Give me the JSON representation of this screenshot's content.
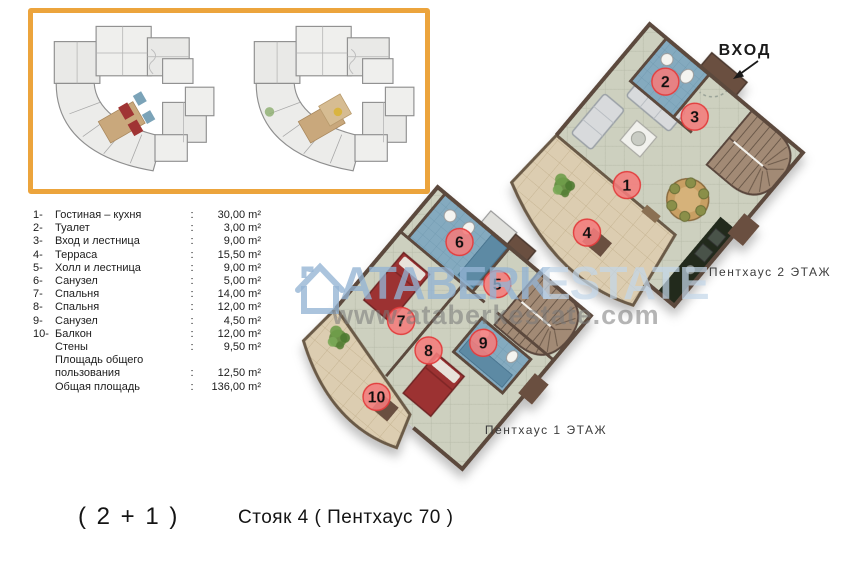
{
  "page": {
    "background": "#ffffff"
  },
  "colors": {
    "accent_border": "#ECA43C",
    "marker_fill": "#F47C7C",
    "marker_ring": "#E23D3D",
    "floor_tile": "#CDD0BF",
    "terrace_tile": "#DCCDB1",
    "bathroom_blue": "#84AABF",
    "bed_red": "#9C3030",
    "wall_brown": "#5C4A3E",
    "stair_brown": "#A28A75",
    "watermark_blue": "#94B4D4",
    "watermark_gray": "#787878"
  },
  "legend": {
    "items": [
      {
        "num": "1-",
        "name": "Гостиная – кухня",
        "sep": ":",
        "value": "30,00 m²"
      },
      {
        "num": "2-",
        "name": "Туалет",
        "sep": ":",
        "value": "3,00 m²"
      },
      {
        "num": "3-",
        "name": "Вход и лестница",
        "sep": ":",
        "value": "9,00 m²"
      },
      {
        "num": "4-",
        "name": "Терраса",
        "sep": ":",
        "value": "15,50 m²"
      },
      {
        "num": "5-",
        "name": "Холл и лестница",
        "sep": ":",
        "value": "9,00 m²"
      },
      {
        "num": "6-",
        "name": "Санузел",
        "sep": ":",
        "value": "5,00 m²"
      },
      {
        "num": "7-",
        "name": "Спальня",
        "sep": ":",
        "value": "14,00 m²"
      },
      {
        "num": "8-",
        "name": "Спальня",
        "sep": ":",
        "value": "12,00 m²"
      },
      {
        "num": "9-",
        "name": "Санузел",
        "sep": ":",
        "value": "4,50 m²"
      },
      {
        "num": "10-",
        "name": "Балкон",
        "sep": ":",
        "value": "12,00 m²"
      },
      {
        "num": "",
        "name": "Стены",
        "sep": ":",
        "value": "9,50 m²"
      },
      {
        "num": "",
        "name": "Площадь общего",
        "sep": "",
        "value": ""
      },
      {
        "num": "",
        "name": "пользования",
        "sep": ":",
        "value": "12,50 m²"
      },
      {
        "num": "",
        "name": "Общая площадь",
        "sep": ":",
        "value": "136,00 m²"
      }
    ]
  },
  "plans": {
    "floor2": {
      "label": "Пентхаус 2 ЭТАЖ",
      "entrance_label": "ВХОД",
      "markers": [
        "1",
        "2",
        "3",
        "4"
      ]
    },
    "floor1": {
      "label": "Пентхаус 1 ЭТАЖ",
      "markers": [
        "5",
        "6",
        "7",
        "8",
        "9",
        "10"
      ]
    }
  },
  "watermark": {
    "brand_left": "ATABERK",
    "brand_right": "ESTATE",
    "url": "www.ataberkestate.com"
  },
  "footer": {
    "unit_type": "( 2 + 1 )",
    "riser": "Стояк 4 ( Пентхаус 70 )"
  }
}
